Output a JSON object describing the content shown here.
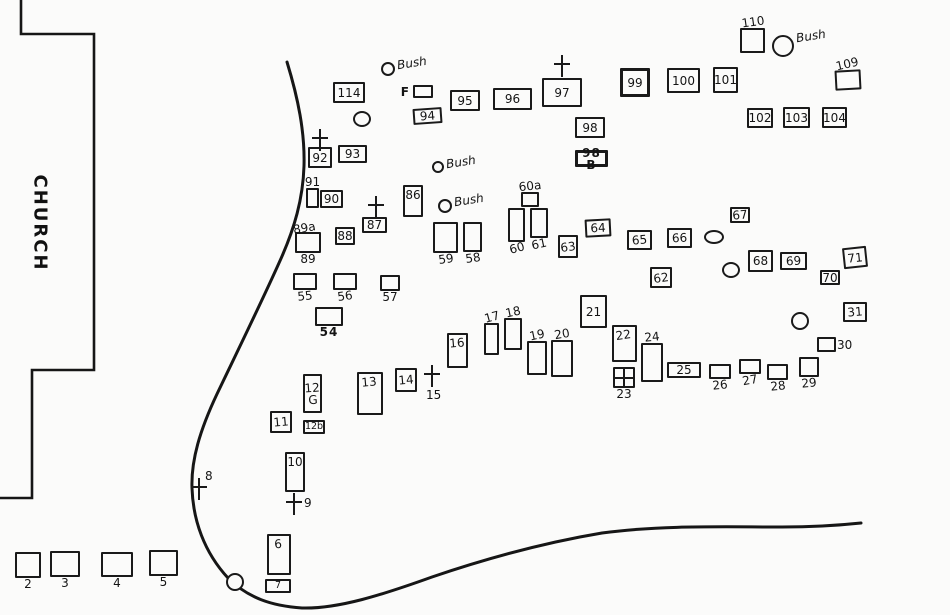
{
  "church": {
    "label": "CHURCH"
  },
  "plots": [
    {
      "label": "114",
      "x": 333,
      "y": 82,
      "w": 32,
      "h": 21,
      "lp": "in"
    },
    {
      "label": "F",
      "x": 413,
      "y": 85,
      "w": 20,
      "h": 13,
      "lp": "left",
      "print": true
    },
    {
      "label": "95",
      "x": 450,
      "y": 90,
      "w": 30,
      "h": 21,
      "lp": "in"
    },
    {
      "label": "96",
      "x": 493,
      "y": 88,
      "w": 39,
      "h": 22,
      "lp": "in"
    },
    {
      "label": "97",
      "x": 542,
      "y": 78,
      "w": 40,
      "h": 29,
      "lp": "in"
    },
    {
      "label": "94",
      "x": 413,
      "y": 108,
      "w": 29,
      "h": 16,
      "lp": "in",
      "btilt": -4
    },
    {
      "label": "98",
      "x": 575,
      "y": 117,
      "w": 30,
      "h": 21,
      "lp": "in"
    },
    {
      "label": "98 B",
      "x": 575,
      "y": 150,
      "w": 33,
      "h": 17,
      "lp": "in",
      "print": true,
      "bold": true
    },
    {
      "label": "99",
      "x": 620,
      "y": 68,
      "w": 30,
      "h": 29,
      "lp": "in",
      "bold": true
    },
    {
      "label": "100",
      "x": 667,
      "y": 68,
      "w": 33,
      "h": 25,
      "lp": "in"
    },
    {
      "label": "101",
      "x": 713,
      "y": 67,
      "w": 25,
      "h": 26,
      "lp": "in"
    },
    {
      "label": "110",
      "x": 740,
      "y": 28,
      "w": 25,
      "h": 25,
      "lp": "above",
      "ltilt": -8
    },
    {
      "label": "109",
      "x": 835,
      "y": 70,
      "w": 26,
      "h": 20,
      "lp": "above",
      "ltilt": -10,
      "btilt": -3
    },
    {
      "label": "102",
      "x": 747,
      "y": 108,
      "w": 26,
      "h": 20,
      "lp": "in"
    },
    {
      "label": "103",
      "x": 783,
      "y": 107,
      "w": 27,
      "h": 21,
      "lp": "in"
    },
    {
      "label": "104",
      "x": 822,
      "y": 107,
      "w": 25,
      "h": 21,
      "lp": "in"
    },
    {
      "label": "92",
      "x": 308,
      "y": 147,
      "w": 24,
      "h": 21,
      "lp": "in"
    },
    {
      "label": "93",
      "x": 338,
      "y": 145,
      "w": 29,
      "h": 18,
      "lp": "in"
    },
    {
      "label": "91",
      "x": 306,
      "y": 188,
      "w": 13,
      "h": 20,
      "lp": "above"
    },
    {
      "label": "90",
      "x": 320,
      "y": 190,
      "w": 23,
      "h": 18,
      "lp": "in"
    },
    {
      "label": "89",
      "x": 295,
      "y": 232,
      "w": 26,
      "h": 21,
      "lp": "below",
      "label2": "89a",
      "l2tilt": -10
    },
    {
      "label": "88",
      "x": 335,
      "y": 227,
      "w": 20,
      "h": 18,
      "lp": "in"
    },
    {
      "label": "87",
      "x": 362,
      "y": 217,
      "w": 25,
      "h": 16,
      "lp": "in"
    },
    {
      "label": "86",
      "x": 403,
      "y": 185,
      "w": 20,
      "h": 32,
      "lp": "in-top"
    },
    {
      "label": "60a",
      "x": 521,
      "y": 192,
      "w": 18,
      "h": 15,
      "lp": "above",
      "ltilt": -6
    },
    {
      "label": "60",
      "x": 508,
      "y": 208,
      "w": 17,
      "h": 34,
      "lp": "below",
      "ltilt": -15
    },
    {
      "label": "61",
      "x": 530,
      "y": 208,
      "w": 18,
      "h": 30,
      "lp": "below",
      "ltilt": -12
    },
    {
      "label": "59",
      "x": 433,
      "y": 222,
      "w": 25,
      "h": 31,
      "lp": "below",
      "ltilt": -8
    },
    {
      "label": "58",
      "x": 463,
      "y": 222,
      "w": 19,
      "h": 30,
      "lp": "below",
      "ltilt": -8
    },
    {
      "label": "63",
      "x": 558,
      "y": 235,
      "w": 20,
      "h": 23,
      "lp": "in",
      "ltilt": -8
    },
    {
      "label": "64",
      "x": 585,
      "y": 219,
      "w": 26,
      "h": 18,
      "lp": "in",
      "btilt": -3
    },
    {
      "label": "65",
      "x": 627,
      "y": 230,
      "w": 25,
      "h": 20,
      "lp": "in",
      "ltilt": -5
    },
    {
      "label": "66",
      "x": 667,
      "y": 228,
      "w": 25,
      "h": 20,
      "lp": "in",
      "ltilt": -3
    },
    {
      "label": "67",
      "x": 730,
      "y": 207,
      "w": 20,
      "h": 16,
      "lp": "in",
      "ltilt": -5
    },
    {
      "label": "62",
      "x": 650,
      "y": 267,
      "w": 22,
      "h": 21,
      "lp": "in",
      "ltilt": -8
    },
    {
      "label": "68",
      "x": 748,
      "y": 250,
      "w": 25,
      "h": 22,
      "lp": "in"
    },
    {
      "label": "69",
      "x": 780,
      "y": 252,
      "w": 27,
      "h": 18,
      "lp": "in",
      "ltilt": -3
    },
    {
      "label": "70",
      "x": 820,
      "y": 270,
      "w": 20,
      "h": 15,
      "lp": "in"
    },
    {
      "label": "71",
      "x": 843,
      "y": 247,
      "w": 24,
      "h": 21,
      "lp": "in",
      "btilt": -6
    },
    {
      "label": "31",
      "x": 843,
      "y": 302,
      "w": 24,
      "h": 20,
      "lp": "in",
      "ltilt": -5
    },
    {
      "label": "30",
      "x": 817,
      "y": 337,
      "w": 19,
      "h": 15,
      "lp": "right"
    },
    {
      "label": "55",
      "x": 293,
      "y": 273,
      "w": 24,
      "h": 17,
      "lp": "below",
      "ltilt": -6
    },
    {
      "label": "56",
      "x": 333,
      "y": 273,
      "w": 24,
      "h": 17,
      "lp": "below",
      "ltilt": -8
    },
    {
      "label": "57",
      "x": 380,
      "y": 275,
      "w": 20,
      "h": 16,
      "lp": "below"
    },
    {
      "label": "54",
      "x": 315,
      "y": 307,
      "w": 28,
      "h": 19,
      "lp": "below",
      "print": true
    },
    {
      "label": "21",
      "x": 580,
      "y": 295,
      "w": 27,
      "h": 33,
      "lp": "in"
    },
    {
      "label": "22",
      "x": 612,
      "y": 325,
      "w": 25,
      "h": 37,
      "lp": "in-top",
      "ltilt": -8
    },
    {
      "label": "23",
      "x": 613,
      "y": 367,
      "w": 22,
      "h": 21,
      "lp": "below",
      "panes": true
    },
    {
      "label": "24",
      "x": 641,
      "y": 343,
      "w": 22,
      "h": 39,
      "lp": "above",
      "ltilt": -6
    },
    {
      "label": "25",
      "x": 667,
      "y": 362,
      "w": 34,
      "h": 16,
      "lp": "in"
    },
    {
      "label": "26",
      "x": 709,
      "y": 364,
      "w": 22,
      "h": 15,
      "lp": "below",
      "ltilt": -6
    },
    {
      "label": "27",
      "x": 739,
      "y": 359,
      "w": 22,
      "h": 15,
      "lp": "below",
      "ltilt": -10
    },
    {
      "label": "28",
      "x": 767,
      "y": 364,
      "w": 21,
      "h": 16,
      "lp": "below",
      "ltilt": -6
    },
    {
      "label": "29",
      "x": 799,
      "y": 357,
      "w": 20,
      "h": 20,
      "lp": "below",
      "ltilt": -6
    },
    {
      "label": "16",
      "x": 447,
      "y": 333,
      "w": 21,
      "h": 35,
      "lp": "in-top",
      "ltilt": -5
    },
    {
      "label": "17",
      "x": 484,
      "y": 323,
      "w": 15,
      "h": 32,
      "lp": "above",
      "ltilt": -15
    },
    {
      "label": "18",
      "x": 504,
      "y": 318,
      "w": 18,
      "h": 32,
      "lp": "above",
      "ltilt": -12
    },
    {
      "label": "19",
      "x": 527,
      "y": 341,
      "w": 20,
      "h": 34,
      "lp": "above",
      "ltilt": -12
    },
    {
      "label": "20",
      "x": 551,
      "y": 340,
      "w": 22,
      "h": 37,
      "lp": "above",
      "ltilt": -10
    },
    {
      "label": "13",
      "x": 357,
      "y": 372,
      "w": 26,
      "h": 43,
      "lp": "in-top",
      "ltilt": -5
    },
    {
      "label": "14",
      "x": 395,
      "y": 368,
      "w": 22,
      "h": 24,
      "lp": "in",
      "ltilt": -5
    },
    {
      "label": "11",
      "x": 270,
      "y": 411,
      "w": 22,
      "h": 22,
      "lp": "in",
      "ltilt": -5
    },
    {
      "label": "12\nG",
      "x": 303,
      "y": 374,
      "w": 19,
      "h": 39,
      "lp": "in",
      "ltilt": -4
    },
    {
      "label": "12b",
      "x": 303,
      "y": 420,
      "w": 22,
      "h": 14,
      "lp": "in",
      "small": true
    },
    {
      "label": "10",
      "x": 285,
      "y": 452,
      "w": 20,
      "h": 40,
      "lp": "in-top"
    },
    {
      "label": "6",
      "x": 267,
      "y": 534,
      "w": 24,
      "h": 41,
      "lp": "in-top",
      "ltilt": -5
    },
    {
      "label": "7",
      "x": 265,
      "y": 579,
      "w": 26,
      "h": 14,
      "lp": "in",
      "small": true
    },
    {
      "label": "2",
      "x": 15,
      "y": 552,
      "w": 26,
      "h": 26,
      "lp": "below"
    },
    {
      "label": "3",
      "x": 50,
      "y": 551,
      "w": 30,
      "h": 26,
      "lp": "below"
    },
    {
      "label": "4",
      "x": 101,
      "y": 552,
      "w": 32,
      "h": 25,
      "lp": "below"
    },
    {
      "label": "5",
      "x": 149,
      "y": 550,
      "w": 29,
      "h": 26,
      "lp": "below"
    }
  ],
  "crosses": [
    {
      "x": 320,
      "y": 140,
      "label": "",
      "lp": ""
    },
    {
      "x": 376,
      "y": 207,
      "label": "",
      "lp": ""
    },
    {
      "x": 562,
      "y": 66,
      "label": "",
      "lp": ""
    },
    {
      "x": 199,
      "y": 489,
      "label": "8",
      "lp": "right-above"
    },
    {
      "x": 294,
      "y": 504,
      "label": "9",
      "lp": "right"
    },
    {
      "x": 432,
      "y": 376,
      "label": "15",
      "lp": "below"
    }
  ],
  "bushes": [
    {
      "x": 388,
      "y": 69,
      "r": 7,
      "label": "Bush"
    },
    {
      "x": 783,
      "y": 46,
      "r": 11,
      "label": "Bush"
    },
    {
      "x": 438,
      "y": 167,
      "r": 6,
      "label": "Bush"
    },
    {
      "x": 445,
      "y": 206,
      "r": 7,
      "label": "Bush"
    }
  ],
  "circles": [
    {
      "x": 362,
      "y": 119,
      "rx": 9,
      "ry": 8
    },
    {
      "x": 714,
      "y": 237,
      "rx": 10,
      "ry": 7
    },
    {
      "x": 731,
      "y": 270,
      "rx": 9,
      "ry": 8
    },
    {
      "x": 800,
      "y": 321,
      "rx": 9,
      "ry": 9
    },
    {
      "x": 235,
      "y": 582,
      "rx": 9,
      "ry": 9
    }
  ]
}
